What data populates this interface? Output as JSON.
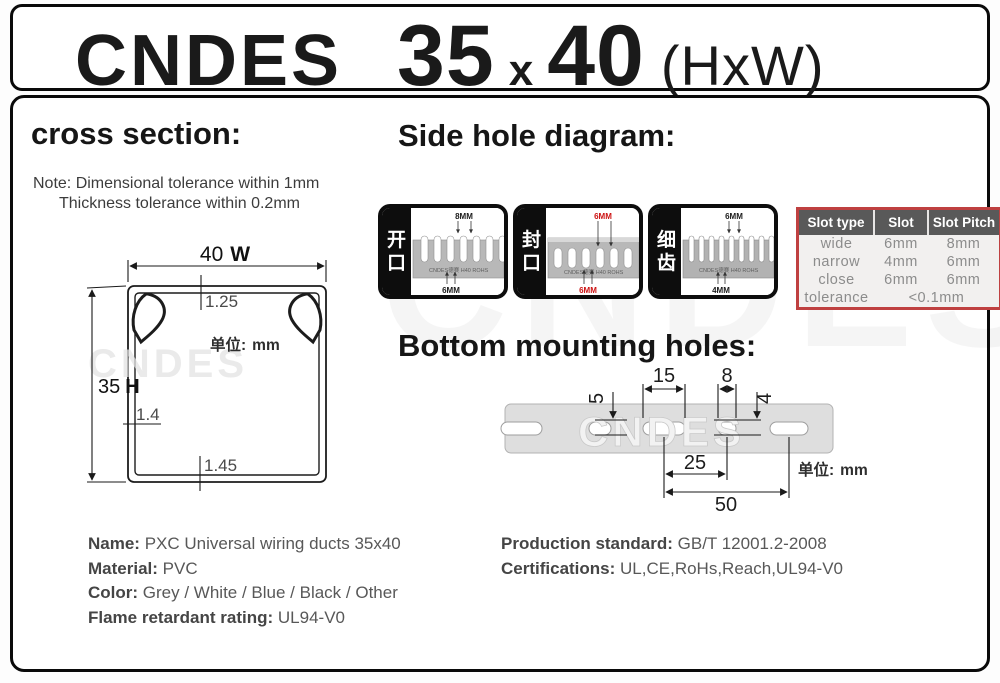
{
  "brand_watermark": "CNDES",
  "header": {
    "brand": "CNDES",
    "dim_h": "35",
    "times": "x",
    "dim_w": "40",
    "suffix": "(HxW)"
  },
  "cross_section": {
    "title": "cross section:",
    "note_line1": "Note: Dimensional tolerance within 1mm",
    "note_line2": "Thickness tolerance within 0.2mm",
    "width_value": "40",
    "width_letter": "W",
    "height_value": "35",
    "height_letter": "H",
    "top_thickness": "1.25",
    "side_thickness": "1.4",
    "bottom_thickness": "1.45",
    "unit_label": "单位:",
    "unit_value": "mm",
    "watermark": "CNDES"
  },
  "side_hole": {
    "title": "Side hole diagram:",
    "cards": [
      {
        "label_top": "开",
        "label_bottom": "口",
        "dim_top": "8MM",
        "dim_bottom": "6MM",
        "dim_color": "#1a1a1a",
        "watermark": "CNDES德赛 H40 ROHS"
      },
      {
        "label_top": "封",
        "label_bottom": "口",
        "dim_top": "6MM",
        "dim_bottom": "6MM",
        "dim_color": "#cc1111",
        "watermark": "CNDES德赛 H40 ROHS"
      },
      {
        "label_top": "细",
        "label_bottom": "齿",
        "dim_top": "6MM",
        "dim_bottom": "4MM",
        "dim_color": "#1a1a1a",
        "watermark": "CNDES德赛 H40 ROHS"
      }
    ],
    "table": {
      "headers": [
        "Slot type",
        "Slot",
        "Slot Pitch"
      ],
      "rows": [
        [
          "wide",
          "6mm",
          "8mm"
        ],
        [
          "narrow",
          "4mm",
          "6mm"
        ],
        [
          "close",
          "6mm",
          "6mm"
        ]
      ],
      "tolerance_label": "tolerance",
      "tolerance_value": "<0.1mm",
      "border_color": "#bf4040",
      "header_bg": "#595959"
    }
  },
  "bottom_holes": {
    "title": "Bottom mounting holes:",
    "dim_slot_long": "15",
    "dim_slot_short": "8",
    "dim_height_long": "5",
    "dim_height_short": "4",
    "dim_pitch": "25",
    "dim_span": "50",
    "unit_label": "单位:",
    "unit_value": "mm",
    "watermark": "CNDES"
  },
  "specs_left": {
    "rows": [
      {
        "label": "Name:",
        "value": "PXC Universal wiring ducts 35x40"
      },
      {
        "label": "Material:",
        "value": "PVC"
      },
      {
        "label": "Color:",
        "value": "Grey / White / Blue / Black / Other"
      },
      {
        "label": "Flame retardant rating:",
        "value": "UL94-V0"
      }
    ]
  },
  "specs_right": {
    "rows": [
      {
        "label": "Production standard:",
        "value": "GB/T 12001.2-2008"
      },
      {
        "label": "Certifications:",
        "value": "UL,CE,RoHs,Reach,UL94-V0"
      }
    ]
  }
}
